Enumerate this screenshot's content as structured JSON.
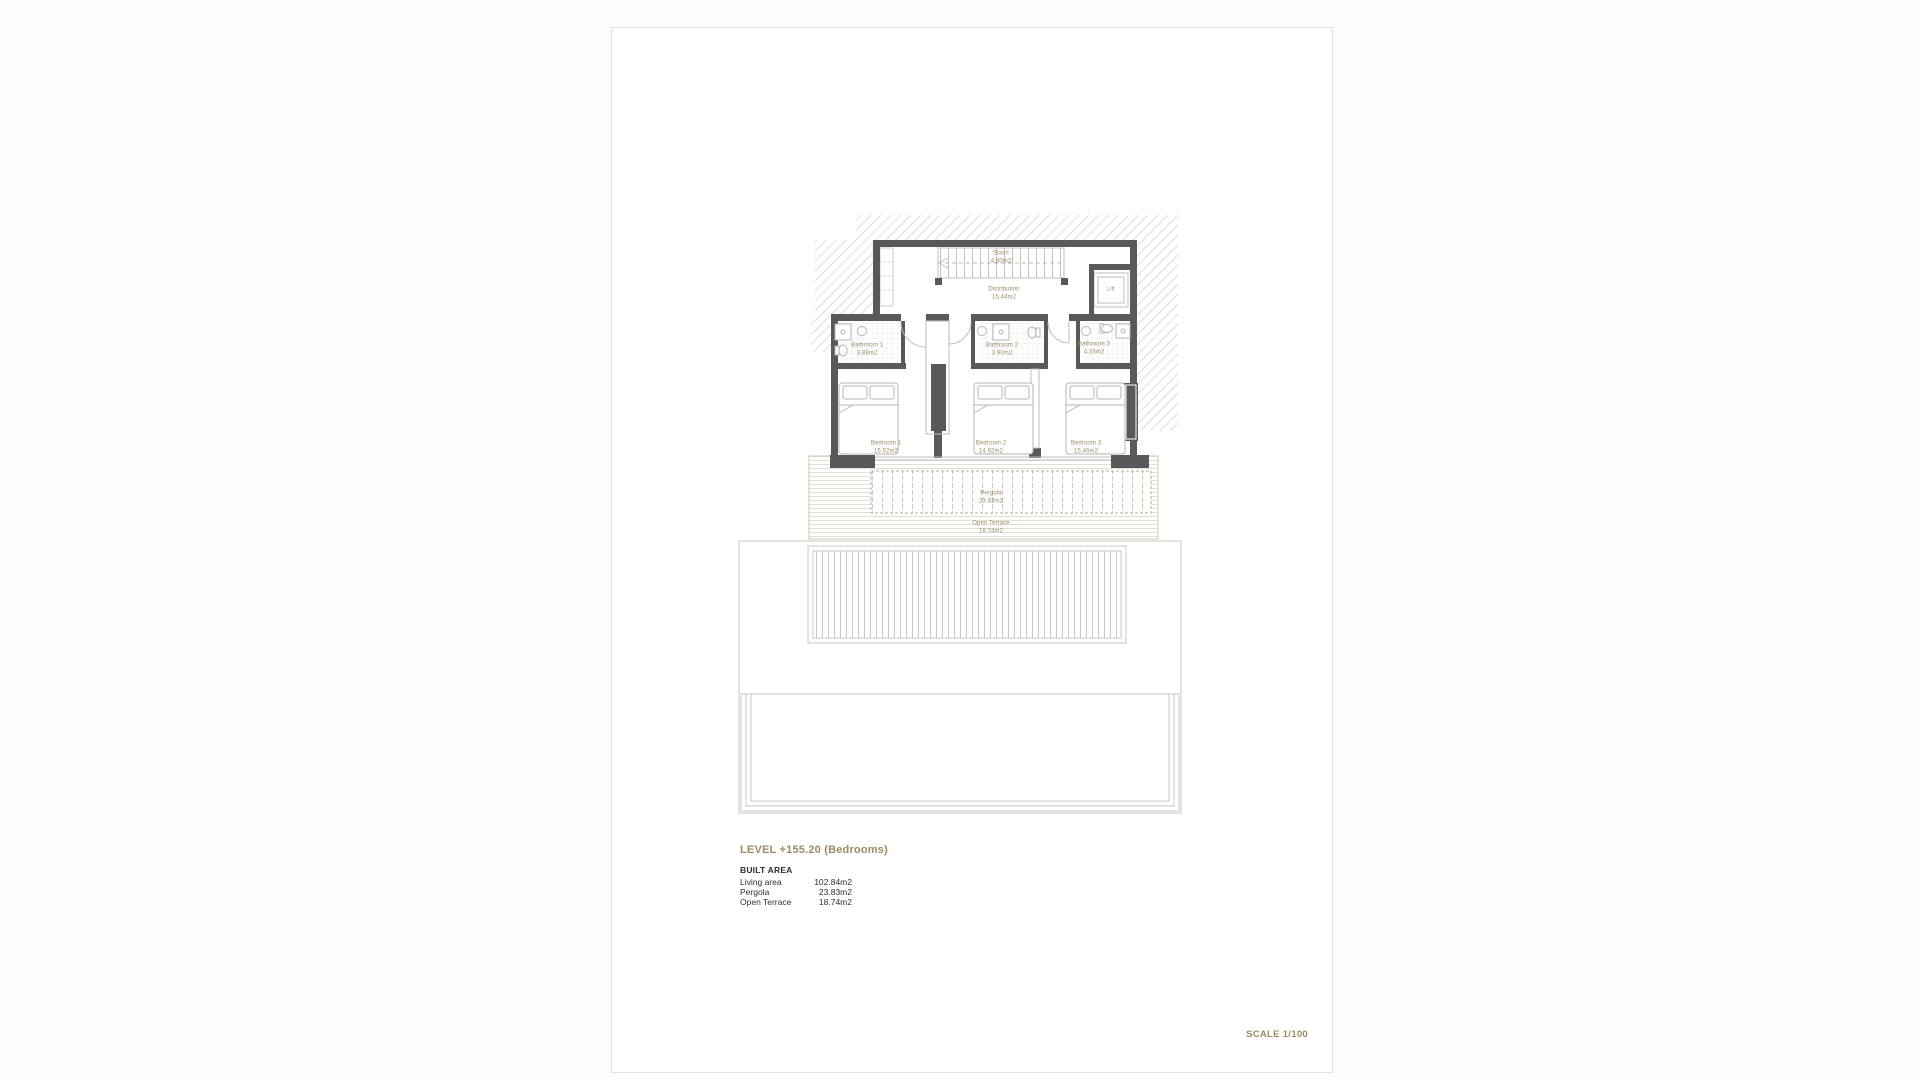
{
  "colors": {
    "accent_tan": "#9c8a62",
    "wall_dark": "#58595b",
    "line_light": "#c9c9c9",
    "hatch_line": "#dcdcdc"
  },
  "rooms": {
    "stairs": {
      "name": "Stairs",
      "area": "4.80m2"
    },
    "distribution": {
      "name": "Distribution",
      "area": "15.44m2"
    },
    "lift": {
      "name": "Lift"
    },
    "bathroom1": {
      "name": "Bathroom 1",
      "area": "3.88m2"
    },
    "bathroom2": {
      "name": "Bathroom 2",
      "area": "3.90m2"
    },
    "bathroom3": {
      "name": "Bathroom 3",
      "area": "4.33m2"
    },
    "bedroom1": {
      "name": "Bedroom 1",
      "area": "15.52m2"
    },
    "bedroom2": {
      "name": "Bedroom 2",
      "area": "14.92m2"
    },
    "bedroom3": {
      "name": "Bedroom 3",
      "area": "15.46m2"
    },
    "pergola": {
      "name": "Pergola",
      "area": "23.83m2"
    },
    "open_terrace": {
      "name": "Open Terrace",
      "area": "18.74m2"
    }
  },
  "legend": {
    "title": "LEVEL +155.20 (Bedrooms)",
    "built_area_title": "BUILT AREA",
    "rows": [
      {
        "label": "Living area",
        "value": "102.84m2"
      },
      {
        "label": "Pergola",
        "value": "23.83m2"
      },
      {
        "label": "Open Terrace",
        "value": "18.74m2"
      }
    ]
  },
  "scale": {
    "label": "SCALE 1/100"
  }
}
